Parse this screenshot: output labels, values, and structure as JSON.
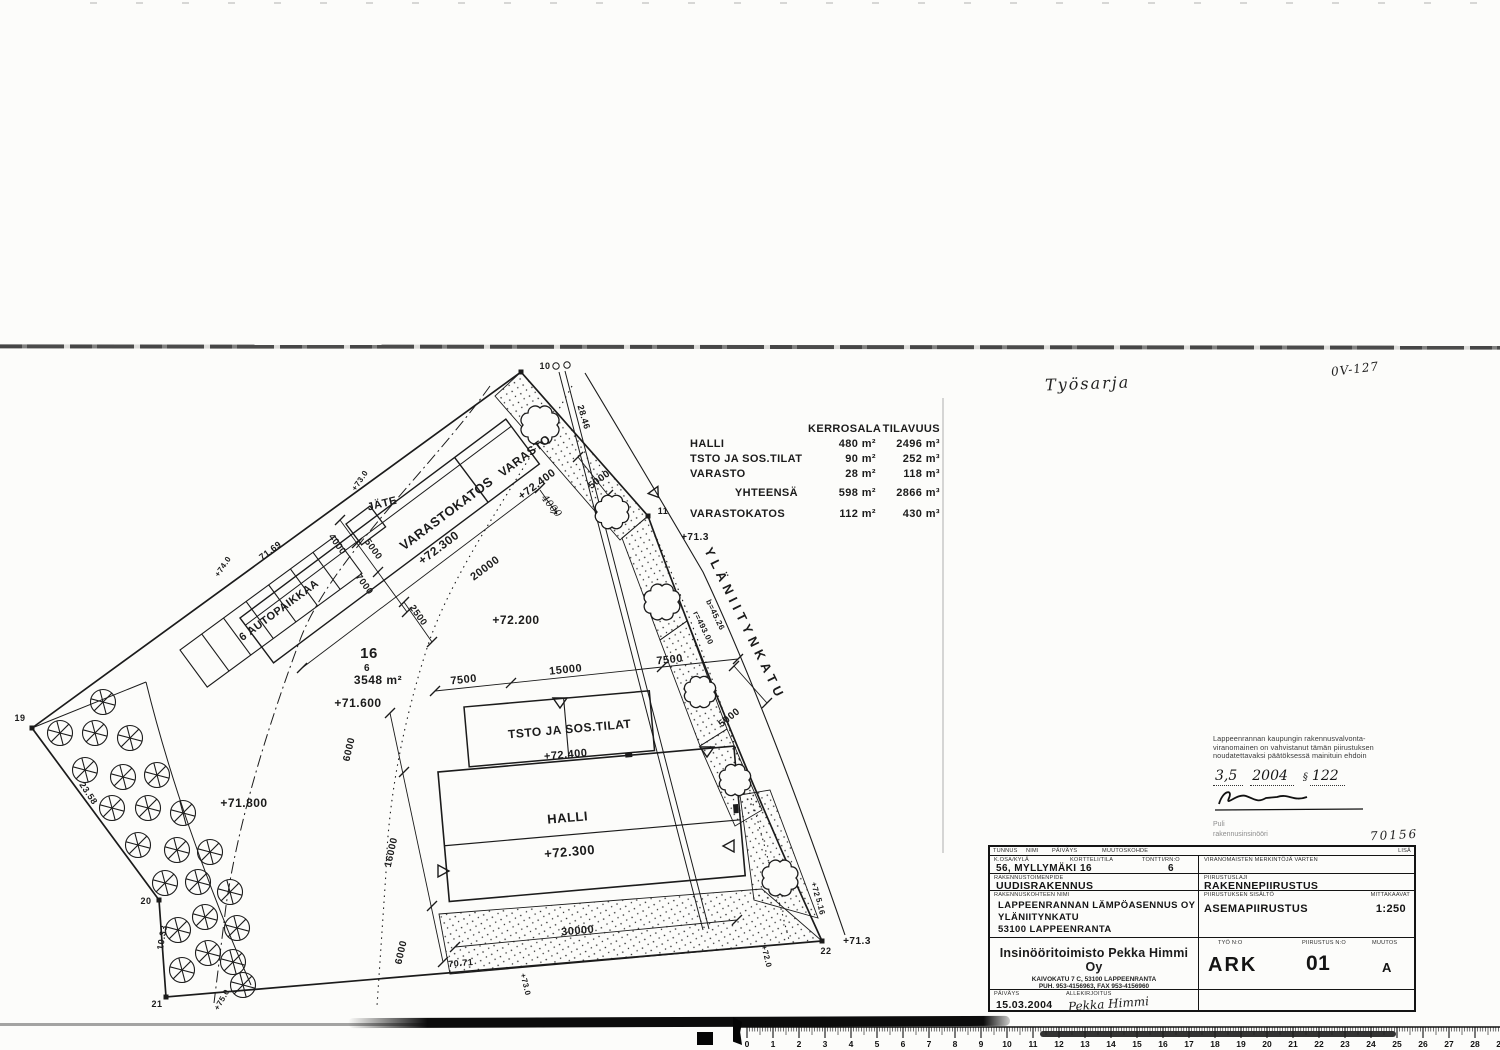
{
  "page": {
    "ink": "#1b1b1b",
    "paper": "#fcfcfa"
  },
  "handwritten": {
    "top_note": "Työsarja",
    "plan_code": "0V-127",
    "ref_number": "70156"
  },
  "area_table": {
    "headers": [
      "KERROSALA",
      "TILAVUUS"
    ],
    "rows": [
      {
        "label": "HALLI",
        "kerrosala": "480 m²",
        "tilavuus": "2496 m³"
      },
      {
        "label": "TSTO JA SOS.TILAT",
        "kerrosala": "90 m²",
        "tilavuus": "252 m³"
      },
      {
        "label": "VARASTO",
        "kerrosala": "28 m²",
        "tilavuus": "118 m³"
      },
      {
        "label": "YHTEENSÄ",
        "kerrosala": "598 m²",
        "tilavuus": "2866 m³"
      },
      {
        "label": "VARASTOKATOS",
        "kerrosala": "112 m²",
        "tilavuus": "430 m³"
      }
    ]
  },
  "stamp": {
    "line1": "Lappeenrannan kaupungin rakennusvalvonta-",
    "line2": "viranomainen on vahvistanut tämän piirustuksen",
    "line3": "noudatettavaksi päätöksessä mainituin ehdoin",
    "approval": {
      "day_month": "3,5",
      "year": "2004",
      "paragraph": "§",
      "number": "122"
    },
    "officer_name": "Puli",
    "officer_title": "rakennusinsinööri"
  },
  "title_block": {
    "tunnus_label": "TUNNUS",
    "nimi_label": "NIMI",
    "paivays_col_label": "PÄIVÄYS",
    "muutoskohde_label": "MUUTOSKOHDE",
    "lisa_label": "LISÄ",
    "kosa_label": "K.OSA/KYLÄ",
    "kosa_value": "56, MYLLYMÄKI",
    "kortteli_label": "KORTTELI/TILA",
    "kortteli_value": "16",
    "tontti_label": "TONTTI/RN:O",
    "tontti_value": "6",
    "viranomaiset_label": "VIRANOMAISTEN MERKINTÖJÄ VARTEN",
    "toimenpide_label": "RAKENNUSTOIMENPIDE",
    "toimenpide_value": "UUDISRAKENNUS",
    "piirustuslaji_label": "PIIRUSTUSLAJI",
    "piirustuslaji_value": "RAKENNEPIIRUSTUS",
    "kohde_label": "RAKENNUSKOHTEEN NIMI",
    "kohde_lines": [
      "LAPPEENRANNAN LÄMPÖASENNUS OY",
      "YLÄNIITYNKATU",
      "53100 LAPPEENRANTA"
    ],
    "sisalto_label": "PIIRUSTUKSEN SISÄLTÖ",
    "sisalto_value": "ASEMAPIIRUSTUS",
    "mittakaava_label": "MITTAKAAVAT",
    "mittakaava_value": "1:250",
    "company_name": "Insinööritoimisto Pekka Himmi Oy",
    "company_addr1": "KAIVOKATU 7 C, 53100 LAPPEENRANTA",
    "company_addr2": "PUH. 953-4156963, FAX 953-4156960",
    "tyo_label": "TYÖ N:O",
    "tyo_value": "ARK",
    "piirustus_label": "PIIRUSTUS N:O",
    "piirustus_value": "01",
    "muutos_label": "MUUTOS",
    "muutos_value": "A",
    "paivays_label": "PÄIVÄYS",
    "paivays_value": "15.03.2004",
    "allekirjoitus_label": "ALLEKIRJOITUS",
    "allekirjoitus_value": "Pekka Himmi"
  },
  "ruler": {
    "start": 0,
    "end": 29
  },
  "plan": {
    "labels": [
      {
        "t": "VARASTO",
        "x": 527,
        "y": 459,
        "r": -36.8,
        "s": 12
      },
      {
        "t": "+72.400",
        "x": 539,
        "y": 487,
        "r": -36.8,
        "s": 11
      },
      {
        "t": "VARASTOKATOS",
        "x": 449,
        "y": 517,
        "r": -36.8,
        "s": 13
      },
      {
        "t": "+72.300",
        "x": 441,
        "y": 551,
        "r": -36.8,
        "s": 12
      },
      {
        "t": "20000",
        "x": 487,
        "y": 571,
        "r": -36.8,
        "s": 11
      },
      {
        "t": "JÄTE",
        "x": 383,
        "y": 507,
        "r": -14,
        "s": 11
      },
      {
        "t": "4000",
        "x": 335,
        "y": 546,
        "r": 54,
        "s": 9.5
      },
      {
        "t": "5000",
        "x": 371,
        "y": 551,
        "r": 54,
        "s": 9.5
      },
      {
        "t": "7000",
        "x": 362,
        "y": 586,
        "r": 54,
        "s": 9.5
      },
      {
        "t": "71.69",
        "x": 272,
        "y": 553,
        "r": -36.8,
        "s": 9
      },
      {
        "t": "+74.0",
        "x": 225,
        "y": 568,
        "r": -56,
        "s": 8
      },
      {
        "t": "+73.0",
        "x": 362,
        "y": 482,
        "r": -56,
        "s": 8
      },
      {
        "t": "6 AUTOPAIKKAA",
        "x": 281,
        "y": 613,
        "r": -36.3,
        "s": 11
      },
      {
        "t": "16",
        "x": 369,
        "y": 658,
        "r": 0,
        "s": 15
      },
      {
        "t": "6",
        "x": 367,
        "y": 671,
        "r": 0,
        "s": 10
      },
      {
        "t": "3548 m²",
        "x": 378,
        "y": 684,
        "r": 0,
        "s": 12
      },
      {
        "t": "+71.600",
        "x": 358,
        "y": 707,
        "r": 0,
        "s": 12
      },
      {
        "t": "+72.200",
        "x": 516,
        "y": 624,
        "r": 0,
        "s": 12
      },
      {
        "t": "2500",
        "x": 416,
        "y": 617,
        "r": 54,
        "s": 9.5
      },
      {
        "t": "+71.800",
        "x": 244,
        "y": 807,
        "r": 0,
        "s": 12
      },
      {
        "t": "23.58",
        "x": 86,
        "y": 795,
        "r": 56,
        "s": 9
      },
      {
        "t": "10.33",
        "x": 165,
        "y": 938,
        "r": -80,
        "s": 9
      },
      {
        "t": "+75.0",
        "x": 224,
        "y": 1001,
        "r": -60,
        "s": 8
      },
      {
        "t": "19",
        "x": 20,
        "y": 721,
        "r": 0,
        "s": 9
      },
      {
        "t": "20",
        "x": 146,
        "y": 904,
        "r": 0,
        "s": 9
      },
      {
        "t": "21",
        "x": 157,
        "y": 1007,
        "r": 0,
        "s": 9
      },
      {
        "t": "22",
        "x": 826,
        "y": 954,
        "r": 0,
        "s": 9
      },
      {
        "t": "10",
        "x": 545,
        "y": 369,
        "r": 0,
        "s": 9
      },
      {
        "t": "11",
        "x": 663,
        "y": 514,
        "r": 0,
        "s": 9
      },
      {
        "t": "+71.3",
        "x": 695,
        "y": 540,
        "r": 0,
        "s": 10
      },
      {
        "t": "YLÄNIITYNKATU",
        "x": 741,
        "y": 626,
        "r": 64,
        "s": 13,
        "c": "street"
      },
      {
        "t": "b=45.26",
        "x": 713,
        "y": 616,
        "r": 64,
        "s": 8
      },
      {
        "t": "r=493.00",
        "x": 701,
        "y": 629,
        "r": 64,
        "s": 8
      },
      {
        "t": "7500",
        "x": 464,
        "y": 683,
        "r": -6,
        "s": 11
      },
      {
        "t": "15000",
        "x": 566,
        "y": 673,
        "r": -6,
        "s": 11
      },
      {
        "t": "7500",
        "x": 670,
        "y": 663,
        "r": -6,
        "s": 11
      },
      {
        "t": "5000",
        "x": 731,
        "y": 720,
        "r": -38,
        "s": 10
      },
      {
        "t": "TSTO JA SOS.TILAT",
        "x": 570,
        "y": 733,
        "r": -5,
        "s": 12
      },
      {
        "t": "+72.400",
        "x": 566,
        "y": 758,
        "r": -5,
        "s": 11
      },
      {
        "t": "HALLI",
        "x": 568,
        "y": 822,
        "r": -5,
        "s": 13
      },
      {
        "t": "+72.300",
        "x": 570,
        "y": 856,
        "r": -5,
        "s": 13
      },
      {
        "t": "6000",
        "x": 352,
        "y": 750,
        "r": -77,
        "s": 10
      },
      {
        "t": "16000",
        "x": 394,
        "y": 853,
        "r": -77,
        "s": 10
      },
      {
        "t": "6000",
        "x": 404,
        "y": 953,
        "r": -77,
        "s": 10
      },
      {
        "t": "30000",
        "x": 578,
        "y": 934,
        "r": -5,
        "s": 11
      },
      {
        "t": "70.71",
        "x": 461,
        "y": 966,
        "r": -5,
        "s": 9
      },
      {
        "t": "+73.0",
        "x": 523,
        "y": 985,
        "r": 76,
        "s": 8
      },
      {
        "t": "+72.0",
        "x": 764,
        "y": 957,
        "r": 76,
        "s": 8
      },
      {
        "t": "+71.3",
        "x": 857,
        "y": 944,
        "r": 0,
        "s": 10
      },
      {
        "t": "5.16",
        "x": 818,
        "y": 907,
        "r": 76,
        "s": 8
      },
      {
        "t": "+72",
        "x": 813,
        "y": 890,
        "r": 76,
        "s": 8
      },
      {
        "t": "28.46",
        "x": 581,
        "y": 418,
        "r": 73,
        "s": 9
      },
      {
        "t": "5000",
        "x": 601,
        "y": 482,
        "r": -36.8,
        "s": 10
      },
      {
        "t": "4000",
        "x": 549,
        "y": 508,
        "r": 50,
        "s": 10,
        "c": "hw"
      }
    ]
  }
}
